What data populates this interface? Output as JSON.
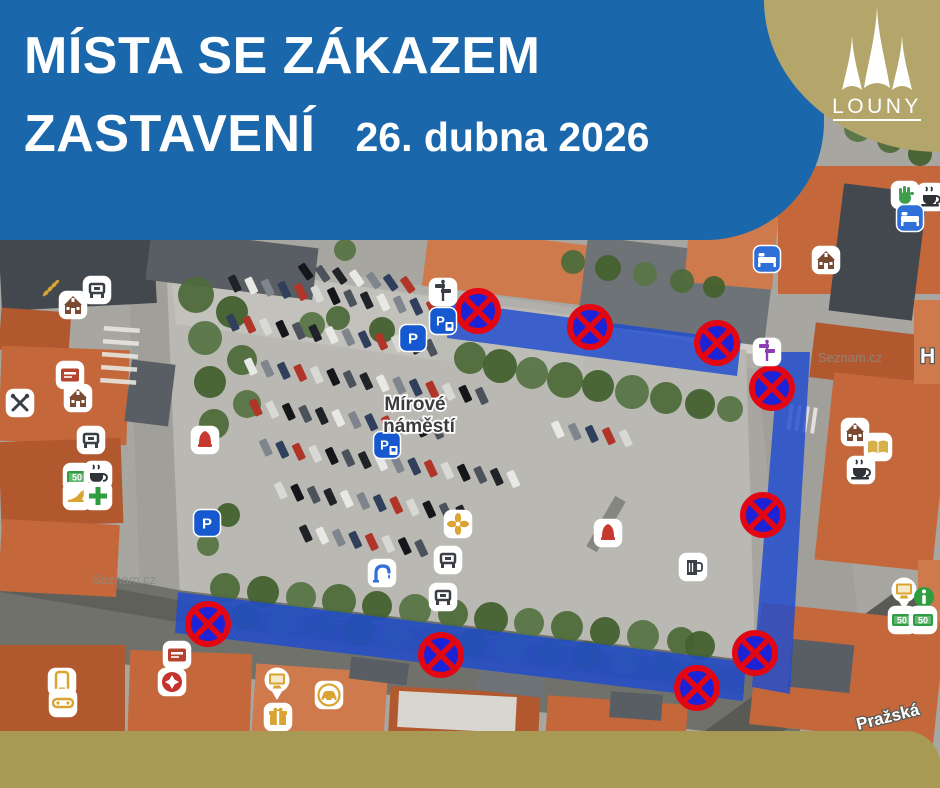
{
  "header": {
    "title_line1": "MÍSTA SE ZÁKAZEM",
    "title_line2": "ZASTAVENÍ",
    "date": "26. dubna 2026",
    "bg": "#1a68ab"
  },
  "logo": {
    "city": "LOUNY",
    "bg": "#b4a56b"
  },
  "footer": {
    "bg": "#a89a55"
  },
  "map": {
    "labels": {
      "square_line1": "Mírové",
      "square_line2": "náměstí",
      "watermark": "Seznam.cz",
      "street_right": "H",
      "street_bottom": "Pražská"
    },
    "palette": {
      "d1": "#43474e",
      "d2": "#595d64",
      "d3": "#6e7378",
      "o1": "#c4683c",
      "o2": "#b2582e",
      "o3": "#cf7a4c",
      "lt": "#d8d6d0"
    },
    "base": [
      {
        "k": "r",
        "x": 0,
        "y": 130,
        "w": 940,
        "h": 658,
        "f": "#a7a6a0"
      },
      {
        "k": "p",
        "pts": "140,244 780,338 780,372 140,278",
        "f": "#b0afa9"
      },
      {
        "k": "p",
        "pts": "300,290 770,344 770,356 300,302",
        "f": "#d5d3cc",
        "o": 0.9
      },
      {
        "k": "p",
        "pts": "166,256 746,350 756,690 178,594",
        "f": "#b9b8b2"
      },
      {
        "k": "p",
        "pts": "170,260 430,296 436,360 176,324",
        "f": "#c6c5bf",
        "o": 0.7
      },
      {
        "k": "p",
        "pts": "430,296 580,316 584,372 436,360",
        "f": "#c2c1bb",
        "o": 0.5
      },
      {
        "k": "p",
        "pts": "128,256 166,256 180,598 140,598",
        "f": "#a09f99"
      },
      {
        "k": "p",
        "pts": "756,350 832,358 866,700 788,694",
        "f": "#a09f99"
      },
      {
        "k": "p",
        "pts": "0,556 178,590 746,660 800,668 800,742 0,650",
        "f": "#71716b"
      },
      {
        "k": "p",
        "pts": "0,568 178,600 744,668 744,694 178,622 0,592",
        "f": "#5c5c56",
        "o": 0.8
      },
      {
        "k": "p",
        "pts": "690,742 906,584 940,604 940,648 762,742",
        "f": "#5a5a54"
      },
      {
        "k": "r",
        "x": 600,
        "y": 495,
        "w": 12,
        "h": 58,
        "rot": 30,
        "f": "#525449",
        "o": 0.5
      }
    ],
    "buildings": [
      {
        "k": "r",
        "x": 0,
        "y": 232,
        "w": 155,
        "h": 75,
        "rot": -3,
        "f": "d1"
      },
      {
        "k": "r",
        "x": 148,
        "y": 238,
        "w": 168,
        "h": 52,
        "rot": 7,
        "f": "d2"
      },
      {
        "k": "r",
        "x": 425,
        "y": 236,
        "w": 168,
        "h": 60,
        "rot": 7,
        "f": "o3"
      },
      {
        "k": "r",
        "x": 582,
        "y": 247,
        "w": 188,
        "h": 88,
        "rot": 7,
        "f": "d3"
      },
      {
        "k": "r",
        "x": 688,
        "y": 198,
        "w": 88,
        "h": 88,
        "rot": 5,
        "f": "o3"
      },
      {
        "k": "r",
        "x": 778,
        "y": 166,
        "w": 165,
        "h": 128,
        "rot": 0,
        "f": "o1"
      },
      {
        "k": "r",
        "x": 836,
        "y": 188,
        "w": 84,
        "h": 128,
        "rot": 7,
        "f": "d1"
      },
      {
        "k": "r",
        "x": 812,
        "y": 330,
        "w": 128,
        "h": 55,
        "rot": 7,
        "f": "o2"
      },
      {
        "k": "r",
        "x": 824,
        "y": 378,
        "w": 118,
        "h": 188,
        "rot": 6,
        "f": "o1"
      },
      {
        "k": "r",
        "x": 914,
        "y": 300,
        "w": 26,
        "h": 84,
        "rot": 0,
        "f": "o3"
      },
      {
        "k": "r",
        "x": 0,
        "y": 310,
        "w": 70,
        "h": 42,
        "rot": 4,
        "f": "o2"
      },
      {
        "k": "r",
        "x": 0,
        "y": 348,
        "w": 128,
        "h": 95,
        "rot": 2,
        "f": "o1"
      },
      {
        "k": "r",
        "x": 0,
        "y": 440,
        "w": 122,
        "h": 85,
        "rot": -2,
        "f": "o2"
      },
      {
        "k": "r",
        "x": 0,
        "y": 522,
        "w": 118,
        "h": 72,
        "rot": 3,
        "f": "o1"
      },
      {
        "k": "r",
        "x": 128,
        "y": 362,
        "w": 44,
        "h": 62,
        "rot": 7,
        "f": "d2"
      },
      {
        "k": "r",
        "x": 0,
        "y": 645,
        "w": 125,
        "h": 143,
        "rot": 0,
        "f": "o2"
      },
      {
        "k": "r",
        "x": 128,
        "y": 652,
        "w": 122,
        "h": 136,
        "rot": 2,
        "f": "o1"
      },
      {
        "k": "r",
        "x": 252,
        "y": 668,
        "w": 132,
        "h": 120,
        "rot": 4,
        "f": "o3"
      },
      {
        "k": "r",
        "x": 388,
        "y": 690,
        "w": 150,
        "h": 98,
        "rot": 3,
        "f": "o2"
      },
      {
        "k": "r",
        "x": 398,
        "y": 694,
        "w": 118,
        "h": 36,
        "rot": 3,
        "f": "lt"
      },
      {
        "k": "r",
        "x": 545,
        "y": 700,
        "w": 140,
        "h": 88,
        "rot": 4,
        "f": "o1"
      },
      {
        "k": "r",
        "x": 755,
        "y": 612,
        "w": 185,
        "h": 122,
        "rot": 6,
        "f": "o1"
      },
      {
        "k": "r",
        "x": 790,
        "y": 642,
        "w": 62,
        "h": 48,
        "rot": 6,
        "f": "d2"
      },
      {
        "k": "r",
        "x": 918,
        "y": 560,
        "w": 22,
        "h": 62,
        "rot": 0,
        "f": "o3"
      },
      {
        "k": "r",
        "x": 610,
        "y": 693,
        "w": 52,
        "h": 26,
        "rot": 4,
        "f": "d2"
      },
      {
        "k": "r",
        "x": 350,
        "y": 660,
        "w": 58,
        "h": 22,
        "rot": 7,
        "f": "d2"
      },
      {
        "k": "r",
        "x": 478,
        "y": 672,
        "w": 66,
        "h": 22,
        "rot": 7,
        "f": "d3"
      }
    ],
    "zebras": [
      {
        "x": 104,
        "y": 326,
        "n": 5,
        "w": 36,
        "h": 4.5,
        "gap": 13,
        "dir": "h",
        "rot": 4
      },
      {
        "x": 790,
        "y": 404,
        "n": 4,
        "w": 4,
        "h": 26,
        "gap": 8,
        "dir": "v",
        "rot": 8
      }
    ],
    "tree_colors": [
      "#4e6c3b",
      "#43612f",
      "#577547"
    ],
    "trees": [
      [
        470,
        358,
        16
      ],
      [
        500,
        366,
        17
      ],
      [
        532,
        373,
        16
      ],
      [
        565,
        380,
        18
      ],
      [
        598,
        386,
        16
      ],
      [
        632,
        392,
        17
      ],
      [
        666,
        398,
        16
      ],
      [
        700,
        404,
        15
      ],
      [
        730,
        409,
        13
      ],
      [
        573,
        262,
        12
      ],
      [
        608,
        268,
        13
      ],
      [
        645,
        274,
        12
      ],
      [
        682,
        281,
        12
      ],
      [
        714,
        287,
        11
      ],
      [
        312,
        325,
        13
      ],
      [
        338,
        318,
        12
      ],
      [
        382,
        330,
        13
      ],
      [
        345,
        250,
        11
      ],
      [
        196,
        295,
        18
      ],
      [
        232,
        312,
        16
      ],
      [
        205,
        338,
        17
      ],
      [
        242,
        360,
        15
      ],
      [
        210,
        382,
        16
      ],
      [
        247,
        404,
        14
      ],
      [
        214,
        424,
        15
      ],
      [
        228,
        515,
        12
      ],
      [
        208,
        545,
        11
      ],
      [
        225,
        588,
        15
      ],
      [
        263,
        592,
        16
      ],
      [
        301,
        597,
        15
      ],
      [
        339,
        601,
        17
      ],
      [
        377,
        606,
        15
      ],
      [
        415,
        610,
        16
      ],
      [
        453,
        614,
        15
      ],
      [
        491,
        619,
        17
      ],
      [
        529,
        623,
        15
      ],
      [
        567,
        627,
        16
      ],
      [
        605,
        632,
        15
      ],
      [
        643,
        636,
        16
      ],
      [
        681,
        641,
        14
      ],
      [
        245,
        617,
        14
      ],
      [
        283,
        621,
        15
      ],
      [
        321,
        626,
        14
      ],
      [
        359,
        630,
        16
      ],
      [
        397,
        635,
        14
      ],
      [
        435,
        639,
        15
      ],
      [
        473,
        643,
        14
      ],
      [
        511,
        648,
        16
      ],
      [
        549,
        652,
        14
      ],
      [
        587,
        656,
        15
      ],
      [
        625,
        661,
        14
      ],
      [
        663,
        665,
        13
      ],
      [
        700,
        646,
        15
      ],
      [
        858,
        128,
        14
      ],
      [
        890,
        140,
        13
      ],
      [
        920,
        154,
        12
      ]
    ],
    "car_colors": [
      "#1f2226",
      "#e8e8e5",
      "#7e858d",
      "#30405c",
      "#b03427",
      "#d8d8d4",
      "#14161a",
      "#4b525b"
    ],
    "car_rows": [
      {
        "x": 306,
        "y": 272,
        "dx": 17,
        "dy": 2.2,
        "n": 7,
        "rot": -35,
        "c0": 6
      },
      {
        "x": 235,
        "y": 284,
        "dx": 16.5,
        "dy": 2.1,
        "n": 13,
        "rot": -25,
        "c0": 0
      },
      {
        "x": 233,
        "y": 323,
        "dx": 16.5,
        "dy": 2.1,
        "n": 13,
        "rot": -25,
        "c0": 3
      },
      {
        "x": 251,
        "y": 367,
        "dx": 16.5,
        "dy": 2.1,
        "n": 15,
        "rot": -25,
        "c0": 1
      },
      {
        "x": 256,
        "y": 408,
        "dx": 16.5,
        "dy": 2.1,
        "n": 12,
        "rot": -25,
        "c0": 4
      },
      {
        "x": 266,
        "y": 448,
        "dx": 16.5,
        "dy": 2.1,
        "n": 16,
        "rot": -25,
        "c0": 2
      },
      {
        "x": 281,
        "y": 491,
        "dx": 16.5,
        "dy": 2.1,
        "n": 12,
        "rot": -25,
        "c0": 5
      },
      {
        "x": 306,
        "y": 534,
        "dx": 16.5,
        "dy": 2.1,
        "n": 8,
        "rot": -25,
        "c0": 0
      },
      {
        "x": 558,
        "y": 430,
        "dx": 17,
        "dy": 2.2,
        "n": 5,
        "rot": -25,
        "c0": 1
      }
    ],
    "zones": {
      "color": "#1f4cd1",
      "opacity": 0.82,
      "polys": [
        "451,302 741,340 737,376 447,338",
        "779,352 810,352 790,694 752,687",
        "178,592 746,662 743,701 175,633"
      ]
    },
    "sign": {
      "ring": "#e30613",
      "fill": "#1c23d6"
    },
    "signs": [
      [
        478,
        311
      ],
      [
        590,
        327
      ],
      [
        717,
        343
      ],
      [
        772,
        388
      ],
      [
        763,
        515
      ],
      [
        755,
        653
      ],
      [
        697,
        688
      ],
      [
        441,
        655
      ],
      [
        208,
        624
      ]
    ],
    "poi_styles": {
      "house": {
        "bg": "#fff",
        "fg": "#7a4a32"
      },
      "bench": {
        "bg": "#fff",
        "fg": "#3a3f46"
      },
      "cup": {
        "bg": "#fff",
        "fg": "#2f3338"
      },
      "bed": {
        "bg": "#2e6fd8",
        "fg": "#ffffff"
      },
      "book": {
        "bg": "#fff",
        "fg": "#d8b04a"
      },
      "hand": {
        "bg": "#fff",
        "fg": "#3f9e4e"
      },
      "money": {
        "bg": "#fff",
        "fg": "#2f9e41"
      },
      "pharm": {
        "bg": "#fff",
        "fg": "#2f9e41"
      },
      "bell": {
        "bg": "#fff",
        "fg": "#c63a30"
      },
      "card": {
        "bg": "#fff",
        "fg": "#b5432f"
      },
      "phone": {
        "bg": "#fff",
        "fg": "#d9a432"
      },
      "ctrl": {
        "bg": "#fff",
        "fg": "#d9a432"
      },
      "monitor": {
        "bg": "none",
        "fg": "#d9a432",
        "size": 36
      },
      "gift": {
        "bg": "#fff",
        "fg": "#d9a432"
      },
      "carb": {
        "bg": "#fff",
        "fg": "#d9a432"
      },
      "utns": {
        "bg": "#fff",
        "fg": "#3a3f46"
      },
      "shoe": {
        "bg": "#fff",
        "fg": "#d9a432"
      },
      "post": {
        "bg": "#fff",
        "fg": "#3a3f46"
      },
      "fount": {
        "bg": "#fff",
        "fg": "#2e6fd8"
      },
      "flower": {
        "bg": "#fff",
        "fg": "#d9a432"
      },
      "info": {
        "bg": "none",
        "fg": "#2f9e41"
      },
      "mug": {
        "bg": "#fff",
        "fg": "#3a3f46"
      },
      "wheat": {
        "bg": "none",
        "fg": "#d9a432"
      },
      "redcross": {
        "bg": "#fff",
        "fg": "#c4332e"
      },
      "p": {
        "bg": "#1558cf",
        "fg": "#ffffff"
      },
      "pauto": {
        "bg": "#1558cf",
        "fg": "#ffffff"
      }
    },
    "pois": [
      [
        "wheat",
        50,
        289
      ],
      [
        "house",
        73,
        305
      ],
      [
        "bench",
        97,
        290
      ],
      [
        "card",
        70,
        375
      ],
      [
        "house",
        78,
        398
      ],
      [
        "bench",
        91,
        440
      ],
      [
        "utns",
        20,
        403
      ],
      [
        "bell",
        205,
        440
      ],
      [
        "money",
        77,
        477
      ],
      [
        "cup",
        98,
        475
      ],
      [
        "shoe",
        77,
        496
      ],
      [
        "pharm",
        98,
        496
      ],
      [
        "p",
        207,
        523
      ],
      [
        "post",
        443,
        292
      ],
      [
        "pauto",
        443,
        321
      ],
      [
        "p",
        413,
        338
      ],
      [
        "pauto",
        387,
        445
      ],
      [
        "flower",
        458,
        524
      ],
      [
        "bench",
        448,
        560
      ],
      [
        "fount",
        382,
        573
      ],
      [
        "bench",
        443,
        597
      ],
      [
        "bell",
        608,
        533
      ],
      [
        "mug",
        693,
        567
      ],
      [
        "post",
        767,
        352,
        "#8b3fb5"
      ],
      [
        "house",
        855,
        432
      ],
      [
        "book",
        878,
        447
      ],
      [
        "cup",
        861,
        470
      ],
      [
        "hand",
        905,
        195
      ],
      [
        "cup",
        931,
        197
      ],
      [
        "bed",
        910,
        218
      ],
      [
        "bed",
        767,
        259
      ],
      [
        "house",
        826,
        260
      ],
      [
        "monitor",
        904,
        593
      ],
      [
        "info",
        924,
        597
      ],
      [
        "money",
        902,
        620
      ],
      [
        "money",
        923,
        620
      ],
      [
        "phone",
        62,
        682
      ],
      [
        "ctrl",
        63,
        703
      ],
      [
        "card",
        177,
        655
      ],
      [
        "redcross",
        172,
        682
      ],
      [
        "monitor",
        277,
        683
      ],
      [
        "gift",
        278,
        717
      ],
      [
        "carb",
        329,
        695
      ]
    ]
  }
}
